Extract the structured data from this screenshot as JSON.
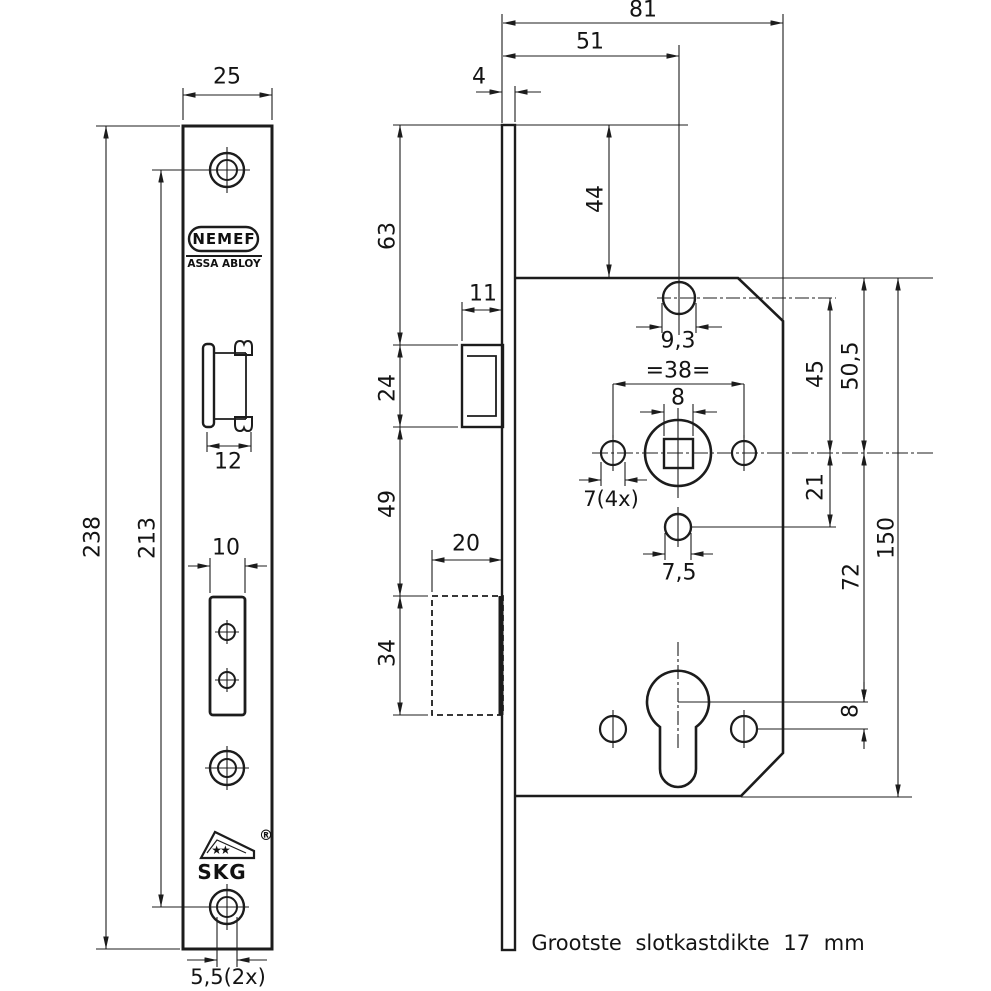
{
  "colors": {
    "background": "#ffffff",
    "line": "#1c1c1c",
    "text": "#141414"
  },
  "branding": {
    "nemef": "NEMEF",
    "assa_abloy": "ASSA ABLOY",
    "skg": "SKG",
    "skg_stars": "★★",
    "registered": "®"
  },
  "note": "Grootste slotkastdikte 17 mm",
  "left_view": {
    "description": "faceplate front view",
    "dims": {
      "plate_width": "25",
      "plate_height": "238",
      "screw_hole_spacing": "213",
      "latch_slot_width": "12",
      "bolt_slot_width": "10",
      "screw_hole_dia": "5,5(2x)"
    }
  },
  "right_view": {
    "description": "lock case side view",
    "dims": {
      "case_width": "81",
      "backset": "51",
      "faceplate_thickness": "4",
      "top_to_latch": "63",
      "top_to_case": "44",
      "latch_depth": "11",
      "latch_height": "24",
      "top_hole_dia": "9,3",
      "follower_screw_spacing": "=38=",
      "spindle_square": "8",
      "screw_hole_dia": "7(4x)",
      "small_hole_dia": "7,5",
      "latch_to_bolt": "49",
      "bolt_depth": "20",
      "bolt_height": "34",
      "tophole_to_spindle": "45",
      "casetop_to_spindle": "50,5",
      "spindle_to_hole": "21",
      "spindle_to_cylinder": "72",
      "cylinder_to_screws": "8",
      "case_height": "150"
    }
  }
}
